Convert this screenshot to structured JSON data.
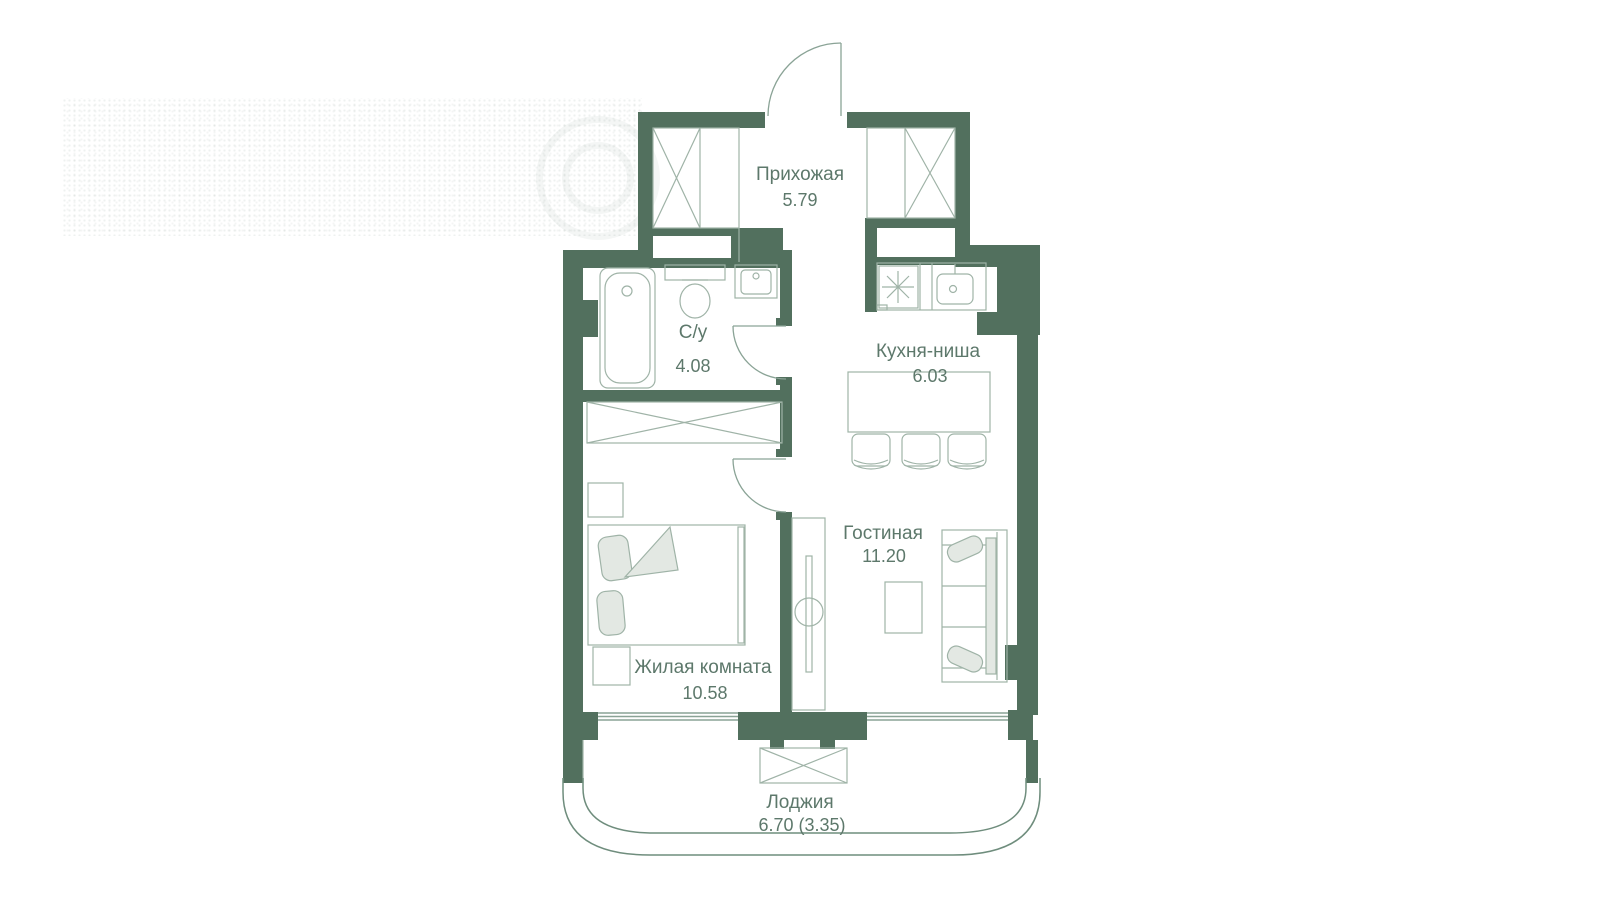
{
  "plan": {
    "title": "Apartment floor plan",
    "rooms": [
      {
        "id": "hallway",
        "name": "Прихожая",
        "area": "5.79"
      },
      {
        "id": "bathroom",
        "name": "С/у",
        "area": "4.08"
      },
      {
        "id": "kitchen",
        "name": "Кухня-ниша",
        "area": "6.03"
      },
      {
        "id": "living",
        "name": "Гостиная",
        "area": "11.20"
      },
      {
        "id": "bedroom",
        "name": "Жилая комната",
        "area": "10.58"
      },
      {
        "id": "loggia",
        "name": "Лоджия",
        "area": "6.70 (3.35)"
      }
    ],
    "colors": {
      "wall": "#52705e",
      "background": "#ffffff",
      "fixture_line": "#9fb3a7",
      "window_line": "#8aa396",
      "door_line": "#8aa396",
      "parapet_line": "#6f8d7d",
      "furniture_fill": "#e3e8e3",
      "text": "#5d786b"
    },
    "fixtures": [
      "entrance-door",
      "hallway-wardrobes",
      "bathtub",
      "toilet",
      "washbasin",
      "washing-machine",
      "kitchen-sink",
      "kitchen-counter",
      "bar-counter",
      "bar-stools",
      "bedroom-wardrobe",
      "bed",
      "bedside-tables",
      "tv-console",
      "coffee-table",
      "sofa",
      "air-conditioner",
      "interior-doors",
      "windows",
      "loggia-parapet"
    ]
  }
}
